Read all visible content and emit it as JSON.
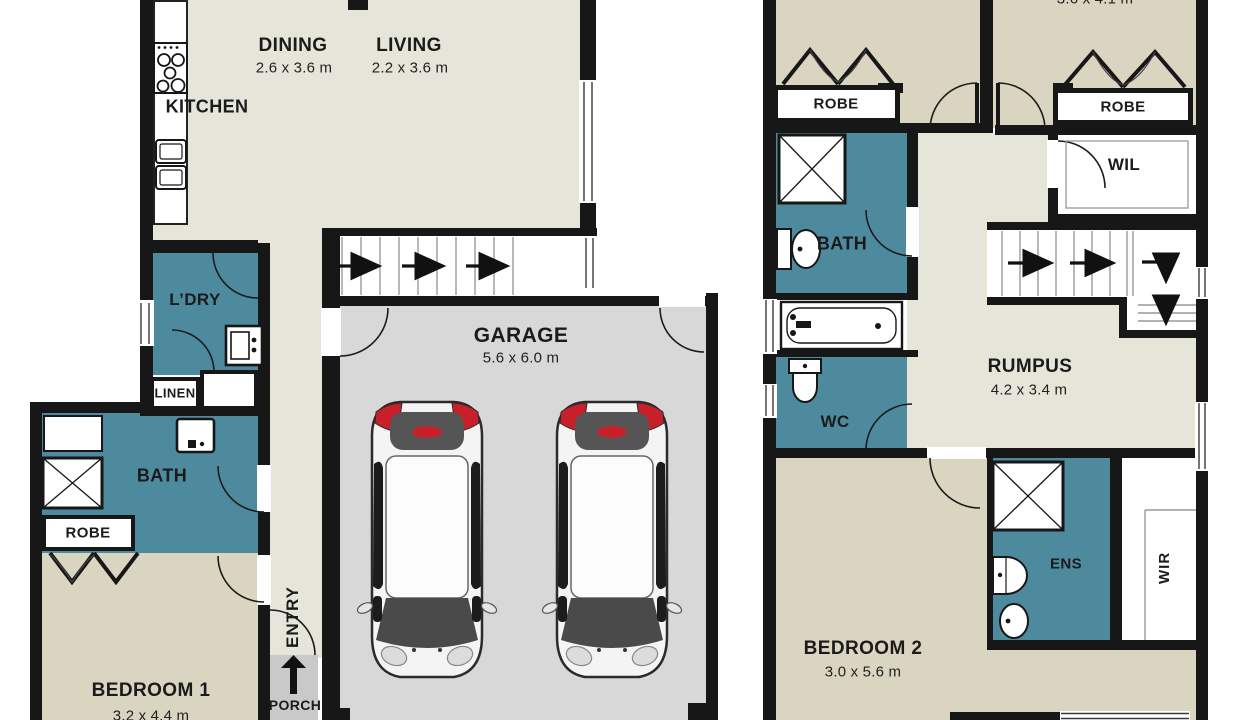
{
  "plan_title": "Two storey house floor plan",
  "colors": {
    "wall": "#171717",
    "living_floor": "#e5e5da",
    "bedroom_floor": "#d9d5c0",
    "wet_area": "#4e8a9e",
    "garage_floor": "#d8d8d8",
    "porch_floor": "#c9c9c9",
    "car_accent_red": "#c8202a"
  },
  "ground_floor": {
    "kitchen": {
      "name": "KITCHEN"
    },
    "dining": {
      "name": "DINING",
      "dim": "2.6 x 3.6 m"
    },
    "living": {
      "name": "LIVING",
      "dim": "2.2 x 3.6 m"
    },
    "laundry": {
      "name": "L’DRY"
    },
    "linen": {
      "name": "LINEN"
    },
    "bath": {
      "name": "BATH"
    },
    "robe": {
      "name": "ROBE"
    },
    "bedroom1": {
      "name": "BEDROOM 1",
      "dim": "3.2 x 4.4 m"
    },
    "entry": {
      "name": "ENTRY"
    },
    "porch": {
      "name": "PORCH"
    },
    "garage": {
      "name": "GARAGE",
      "dim": "5.6 x 6.0 m"
    }
  },
  "upper_floor": {
    "bedroom_top_dim_cropped": "3.6 x 4.1 m",
    "robe_left": {
      "name": "ROBE"
    },
    "robe_right": {
      "name": "ROBE"
    },
    "wil": {
      "name": "WIL"
    },
    "bath": {
      "name": "BATH"
    },
    "wc": {
      "name": "WC"
    },
    "rumpus": {
      "name": "RUMPUS",
      "dim": "4.2 x 3.4 m"
    },
    "bedroom2": {
      "name": "BEDROOM 2",
      "dim": "3.0 x 5.6 m"
    },
    "ens": {
      "name": "ENS"
    },
    "wir": {
      "name": "WIR"
    }
  },
  "fixtures": [
    "stove-cooktop",
    "double-sink",
    "washing-machine",
    "laundry-sink",
    "vanity",
    "shower",
    "toilet",
    "bathtub",
    "basin",
    "car",
    "car",
    "stairs-direction-arrows",
    "porch-entry-arrow",
    "door-swing-arcs",
    "windows"
  ]
}
